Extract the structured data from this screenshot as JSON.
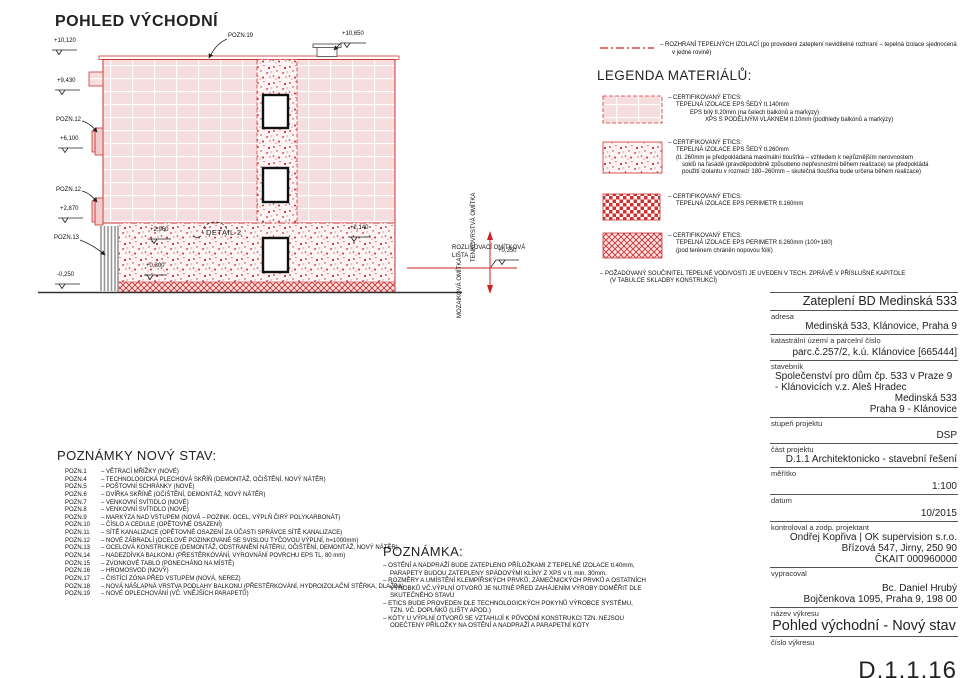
{
  "colors": {
    "accent_red": "#cc2222",
    "fill_pink": "#f7dede",
    "speckle_red": "#c62828",
    "line_black": "#333333"
  },
  "drawing": {
    "title": "POHLED VÝCHODNÍ",
    "elev_top_left": "+10,120",
    "elev_attic": "+9,430",
    "elev_mid": "+6,100",
    "elev_low": "+2,870",
    "elev_ground": "-0,250",
    "elev_chimney": "+10,650",
    "elev_sokl_left": "+2,960",
    "elev_sokl_right": "+2,140",
    "elev_base": "+0,300",
    "elev_strip": "+0,350",
    "label_pozn19": "POZN.19",
    "label_pozn12a": "POZN.12",
    "label_pozn12b": "POZN.12",
    "label_pozn13": "POZN.13",
    "label_detail": "DETAIL 2",
    "label_edge_strip_1": "ROZLIŠOVACÍ OMÍTKOVÁ",
    "label_edge_strip_2": "LIŠTA",
    "label_render_top": "TENKOVRSTVÁ OMÍTKA",
    "label_render_bottom": "MOZAIKOVÁ OMÍTKA"
  },
  "boundary_note": {
    "line1": "– ROZHRANÍ TEPELNÝCH IZOLACÍ (po provedení zateplení neviditelné rozhraní – tepelná izolace sjednocená",
    "line2": "v jedné rovině)"
  },
  "legend": {
    "title": "LEGENDA MATERIÁLŮ:",
    "items": [
      {
        "lines": [
          "– CERTIFIKOVANÝ ETICS:",
          "TEPELNÁ IZOLACE EPS ŠEDÝ tl.140mm",
          "EPS bílý tl.20mm (na čelech balkónů a markýzy)",
          "XPS S PODÉLNÝM VLÁKNEM tl.10mm (podhledy balkónů a markýzy)"
        ]
      },
      {
        "lines": [
          "– CERTIFIKOVANÝ ETICS:",
          "TEPELNÁ IZOLACE EPS ŠEDÝ tl.260mm",
          "(tl. 260mm je předpokládaná maximální tloušťka – vzhledem k nejrůznějším nerovnostem",
          "soklů na fasádě (pravděpodobně způsobeno nepřesnostmi během realizace) se předpokládá",
          "použití izolantu v rozmezí 180–260mm – skutečná tloušťka bude určena během realizace)"
        ]
      },
      {
        "lines": [
          "– CERTIFIKOVANÝ ETICS:",
          "TEPELNÁ IZOLACE EPS PERIMETR tl.160mm"
        ]
      },
      {
        "lines": [
          "– CERTIFIKOVANÝ ETICS:",
          "TEPELNÁ IZOLACE EPS PERIMETR tl.260mm (100+160)",
          "(pod terénem chráněn nopovou fólií)"
        ]
      }
    ],
    "footnote1": "– POŽADOVANÝ SOUČINITEL TEPELNÉ VODIVOSTI JE UVEDEN V TECH. ZPRÁVĚ V PŘÍSLUŠNÉ KAPITOLE",
    "footnote2": "(V TABULCE SKLADBY KONSTRUKCÍ)"
  },
  "notes": {
    "title": "POZNÁMKY NOVÝ STAV:",
    "items": [
      {
        "id": "POZN.1",
        "text": "– VĚTRACÍ MŘÍŽKY (NOVÉ)"
      },
      {
        "id": "POZN.4",
        "text": "– TECHNOLOGICKÁ PLECHOVÁ SKŘÍŇ (DEMONTÁŽ, OČIŠTĚNÍ, NOVÝ NÁTĚR)"
      },
      {
        "id": "POZN.5",
        "text": "– POŠTOVNÍ SCHRÁNKY (NOVÉ)"
      },
      {
        "id": "POZN.6",
        "text": "– DVÍŘKA SKŘÍNĚ (OČIŠTĚNÍ, DEMONTÁŽ, NOVÝ NÁTĚR)"
      },
      {
        "id": "POZN.7",
        "text": "– VENKOVNÍ SVÍTIDLO (NOVÉ)"
      },
      {
        "id": "POZN.8",
        "text": "– VENKOVNÍ SVÍTIDLO (NOVÉ)"
      },
      {
        "id": "POZN.9",
        "text": "– MARKÝZA NAD VSTUPEM (NOVÁ – POZINK. OCEL, VÝPLŇ ČIRÝ POLYKARBONÁT)"
      },
      {
        "id": "POZN.10",
        "text": "– ČÍSLO A CEDULE (OPĚTOVNÉ OSAZENÍ)"
      },
      {
        "id": "POZN.11",
        "text": "– SÍTĚ KANALIZACE (OPĚTOVNÉ OSAZENÍ ZA ÚČASTI SPRÁVCE SÍTĚ KANALIZACE)"
      },
      {
        "id": "POZN.12",
        "text": "– NOVÉ ZÁBRADLÍ (OCELOVÉ POZINKOVANÉ SE SVISLOU TYČOVOU VÝPLNÍ, h=1000mm)"
      },
      {
        "id": "POZN.13",
        "text": "– OCELOVÁ KONSTRUKCE (DEMONTÁŽ, ODSTRANĚNÍ NÁTĚRU, OČIŠTĚNÍ, DEMONTÁŽ, NOVÝ NÁTĚR)"
      },
      {
        "id": "POZN.14",
        "text": "– NADEZDÍVKA BALKONU (PŘESTĚRKOVÁNÍ, VYROVNÁNÍ POVRCHU EPS TL. 80 mm)"
      },
      {
        "id": "POZN.15",
        "text": "– ZVONKOVÉ TABLO (PONECHÁNO NA MÍSTĚ)"
      },
      {
        "id": "POZN.16",
        "text": "– HROMOSVOD (NOVÝ)"
      },
      {
        "id": "POZN.17",
        "text": "– ČISTÍCÍ ZÓNA PŘED VSTUPEM (NOVÁ, NEREZ)"
      },
      {
        "id": "POZN.18",
        "text": "– NOVÁ NÁŠLAPNÁ VRSTVA PODLAHY BALKONU (PŘESTĚRKOVÁNÍ, HYDROIZOLAČNÍ STĚRKA, DLAŽBA)"
      },
      {
        "id": "POZN.19",
        "text": "– NOVÉ OPLECHOVÁNÍ (VČ. VNĚJŠÍCH PARAPETŮ)"
      }
    ]
  },
  "remark": {
    "title": "POZNÁMKA:",
    "lines": [
      "– OSTĚNÍ A NADPRAŽÍ BUDE ZATEPLENO PŘÍLOŽKAMI Z TEPELNÉ IZOLACE tl.40mm,",
      "PARAPETY BUDOU ZATEPLENY SPÁDOVÝMI KLÍNY Z XPS v tl. min. 30mm.",
      "– ROZMĚRY A UMÍSTĚNÍ KLEMPÍŘSKÝCH PRVKŮ, ZÁMEČNICKÝCH PRVKŮ A OSTATNÍCH",
      "VÝROBKŮ VČ.VÝPLNÍ OTVORŮ JE NUTNÉ PŘED ZAHÁJENÍM VÝROBY DOMĚŘIT DLE",
      "SKUTEČNÉHO STAVU",
      "– ETICS BUDE PROVEDEN DLE TECHNOLOGICKÝCH POKYNŮ VÝROBCE SYSTÉMU,",
      "TZN. VČ. DOPLŇKŮ (LIŠTY APOD.)",
      "– KÓTY U VÝPLNÍ OTVORŮ SE VZTAHUJÍ K PŮVODNÍ KONSTRUKCI TZN. NEJSOU",
      "ODEČTENY PŘÍLOŽKY NA OSTĚNÍ A NADPRAŽÍ A PARAPETNÍ KÓTY"
    ]
  },
  "titleblock": {
    "project": "Zateplení BD Medinská 533",
    "adresa_label": "adresa",
    "adresa": "Medinská 533, Klánovice, Praha 9",
    "kat_label": "katastrální území a parcelní číslo",
    "kat": "parc.č.257/2, k.ú. Klánovice [665444]",
    "stavebnik_label": "stavebník",
    "stavebnik": [
      "Společenství pro dům čp. 533 v Praze 9",
      "- Klánovicích v.z. Aleš Hradec",
      "Medinská 533",
      "Praha 9 - Klánovice"
    ],
    "stupen_label": "stupeň projektu",
    "stupen": "DSP",
    "cast_label": "část projektu",
    "cast": "D.1.1 Architektonicko - stavební řešení",
    "meritko_label": "měřítko",
    "meritko": "1:100",
    "datum_label": "datum",
    "datum": "10/2015",
    "kontroloval_label": "kontroloval a zodp. projektant",
    "kontroloval": [
      "Ondřej Kopřiva | OK supervision s.r.o.",
      "Břízová 547, Jirny, 250 90",
      "ČKAIT 000960000"
    ],
    "vypracoval_label": "vypracoval",
    "vypracoval": [
      "Bc. Daniel Hrubý",
      "Bojčenkova 1095, Praha 9, 198 00"
    ],
    "nazev_label": "název výkresu",
    "nazev": "Pohled východní - Nový stav",
    "cislo_label": "číslo výkresu",
    "cislo": "D.1.1.16"
  }
}
